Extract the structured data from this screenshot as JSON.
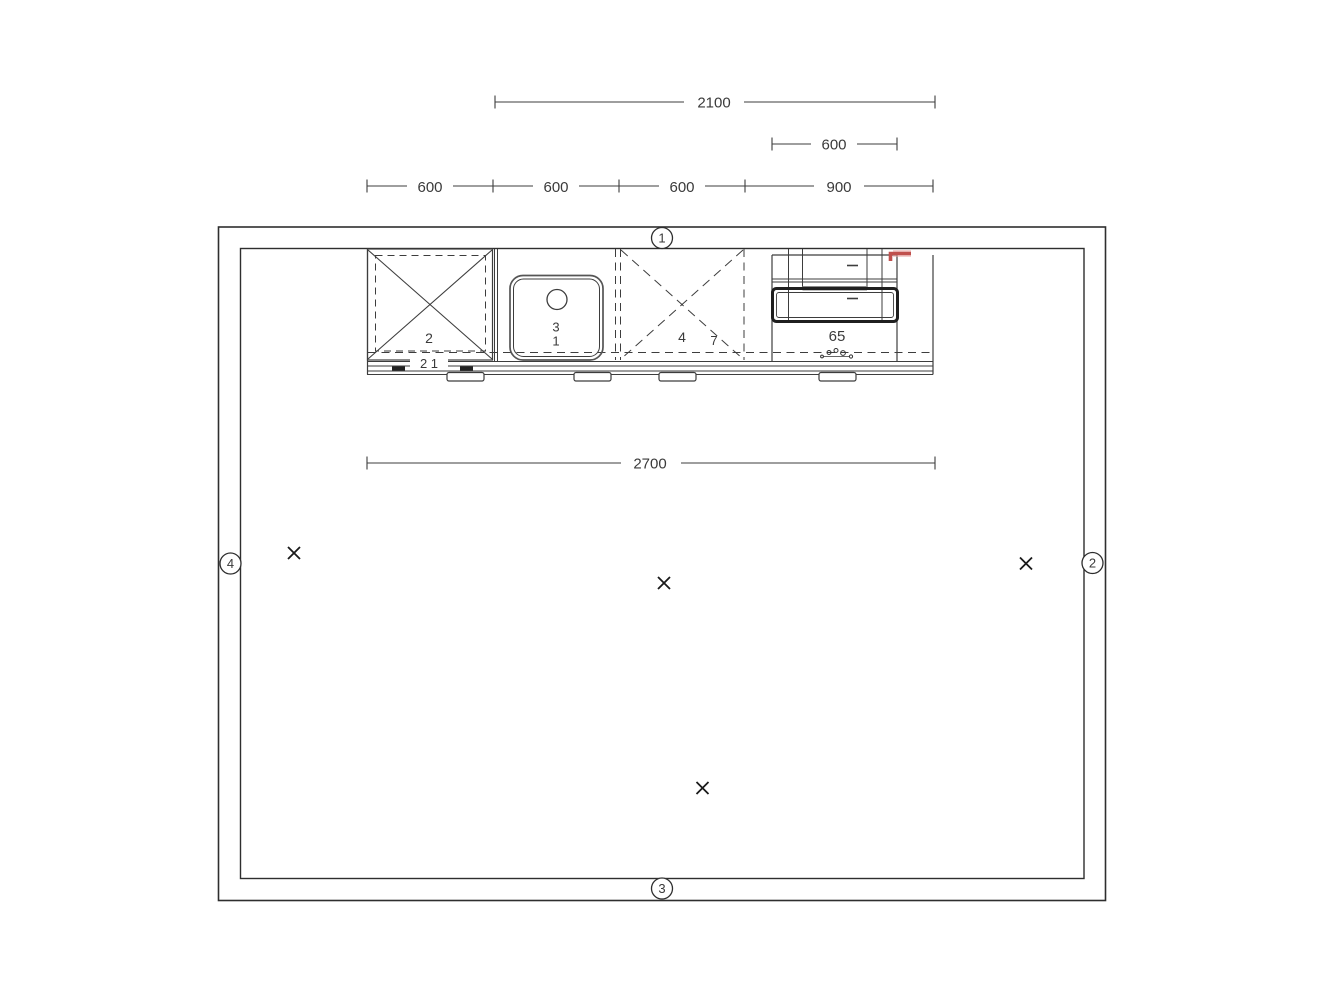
{
  "title": "kitchen-floor-plan-top-view",
  "dimensions": {
    "overall_top": {
      "value": "2100"
    },
    "appliance_width": {
      "value": "600"
    },
    "modules": [
      {
        "label": "600"
      },
      {
        "label": "600"
      },
      {
        "label": "600"
      },
      {
        "label": "900"
      }
    ],
    "run_width": {
      "value": "2700"
    }
  },
  "objects": {
    "corner_cabinet": {
      "label": "2",
      "sublabel": "2 1"
    },
    "sink_cabinet": {
      "label_top": "3",
      "label_bottom": "1"
    },
    "dashed_cabinet": {
      "label": "4",
      "sublabel": "7"
    },
    "range_appliance": {
      "label": "65"
    }
  },
  "wall_markers": {
    "top": "1",
    "right": "2",
    "bottom": "3",
    "left": "4"
  },
  "colors": {
    "line": "#3d3d3d",
    "wall": "#2e2e2e",
    "accent_red": "#c0504d",
    "accent_red_soft": "#eaa8a6"
  },
  "icons": {
    "position_cross": "x-cross-mark",
    "burner_symbol": "small-circle-cluster",
    "sink_drain": "circle"
  }
}
